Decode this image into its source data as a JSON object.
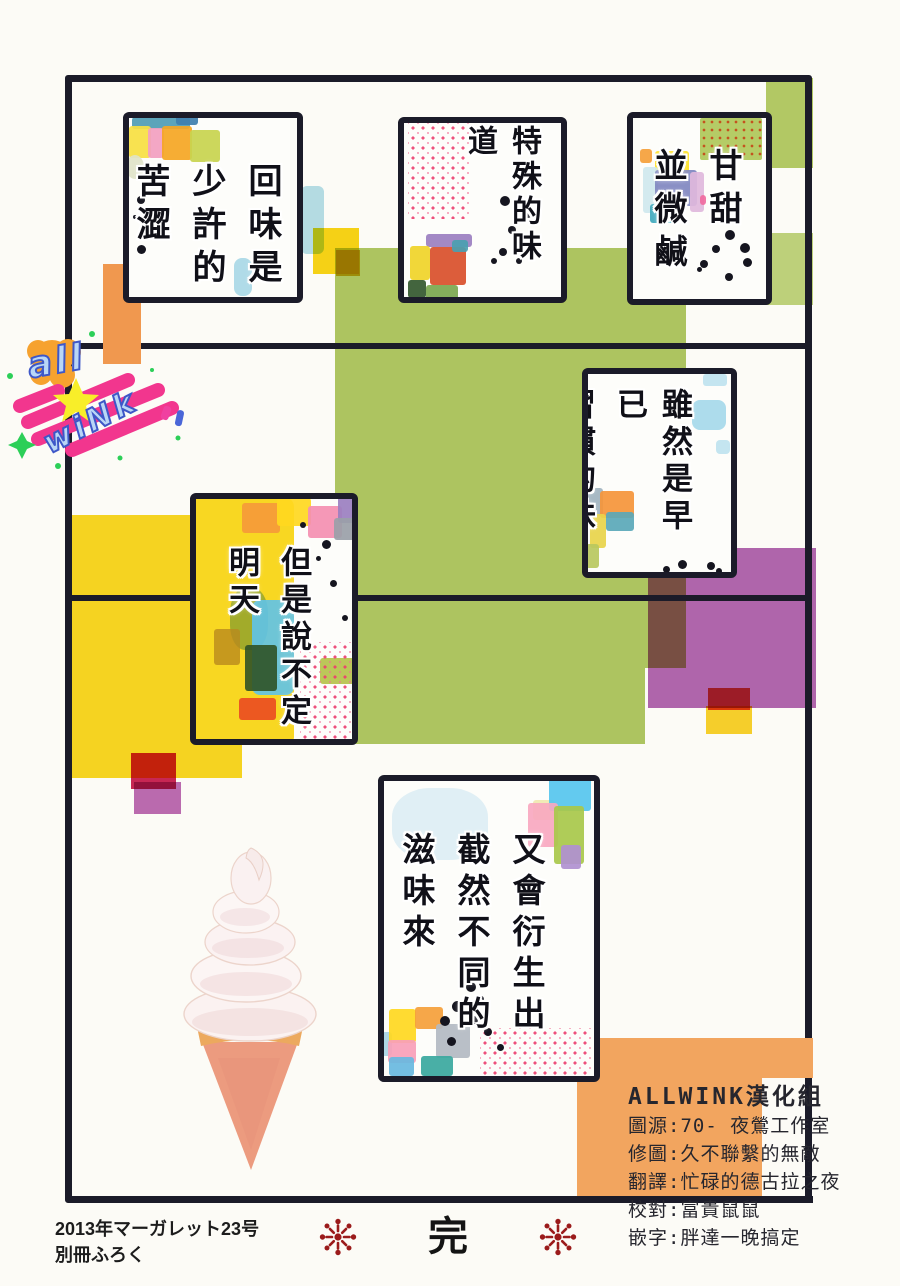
{
  "page": {
    "type": "manga-page",
    "end_mark": "完",
    "magazine_note_line1": "2013年マーガレット23号",
    "magazine_note_line2": "別冊ふろく"
  },
  "panels": [
    {
      "name": "panel-aftertaste",
      "columns": [
        "回味是",
        "少許的",
        "苦澀"
      ]
    },
    {
      "name": "panel-special-flavor",
      "columns": [
        "特殊的味道"
      ]
    },
    {
      "name": "panel-sweet-salty",
      "columns": [
        "甘甜",
        "並微鹹"
      ]
    },
    {
      "name": "panel-familiar-taste",
      "columns": [
        "雖然是早已",
        "習慣的味道"
      ]
    },
    {
      "name": "panel-but-maybe-tomorrow",
      "columns": [
        "但是說不定",
        "明天"
      ]
    },
    {
      "name": "panel-different-flavor",
      "columns": [
        "又會衍生出",
        "截然不同的",
        "滋味來"
      ]
    }
  ],
  "logo": {
    "word1": "all",
    "word2": "wiNk"
  },
  "credits": {
    "title": "ALLWINK漢化組",
    "lines": [
      "圖源:70- 夜鶯工作室",
      "修圖:久不聯繫的無敵",
      "翻譯:忙碌的德古拉之夜",
      "校對:富貴鼠鼠",
      "嵌字:胖達一晚搞定"
    ]
  },
  "colors": {
    "ink": "#1b1b29",
    "olive_green": "#a8c256",
    "yellow": "#f8d516",
    "purple": "#a34ba3",
    "orange": "#f2a55f",
    "crimson": "#c50f45",
    "lattice_pink": "#ee3c6e",
    "logo_pink": "#f2368e",
    "logo_blue_fill": "#b9d6f6",
    "logo_blue_stroke": "#3e57c8",
    "end_mark_red": "#9b1b1b"
  }
}
